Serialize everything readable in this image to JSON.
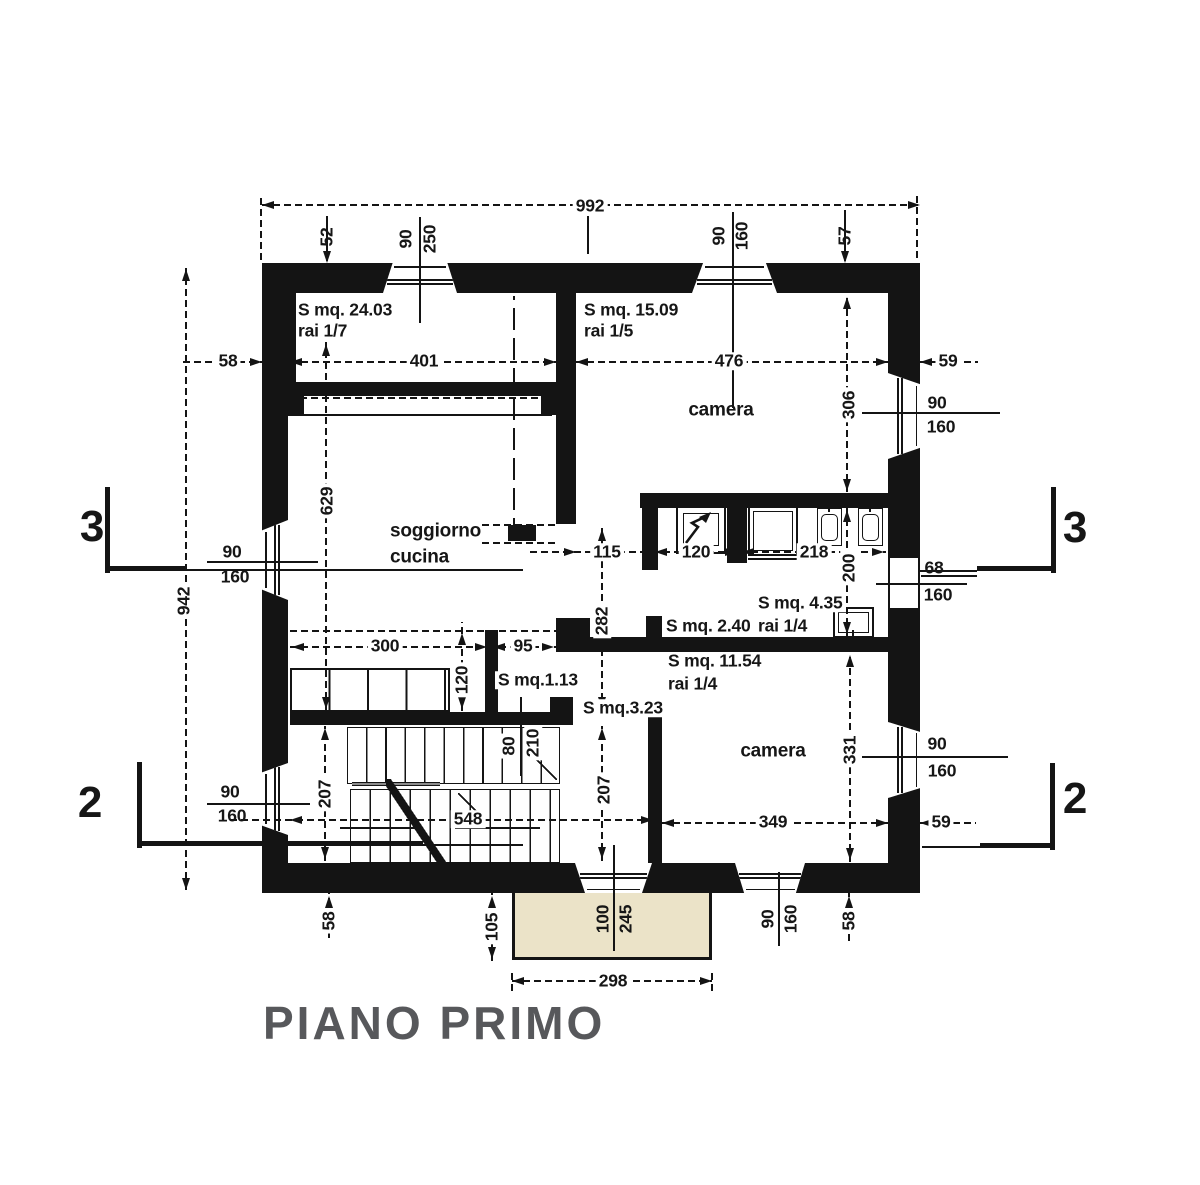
{
  "title": "PIANO PRIMO",
  "drawing": {
    "colors": {
      "ink": "#141414",
      "balcony_fill": "#ebe3c8",
      "rail_fill": "#8b8b8b",
      "title_color": "#57585b",
      "background": "#ffffff"
    },
    "walls": [
      [
        262,
        263,
        658,
        30
      ],
      [
        262,
        263,
        34,
        152
      ],
      [
        262,
        414,
        26,
        479
      ],
      [
        888,
        263,
        32,
        630
      ],
      [
        262,
        863,
        658,
        30
      ],
      [
        556,
        293,
        20,
        231
      ],
      [
        300,
        382,
        243,
        14
      ],
      [
        290,
        382,
        14,
        33
      ],
      [
        541,
        382,
        15,
        33
      ],
      [
        508,
        525,
        28,
        16
      ],
      [
        640,
        493,
        248,
        15
      ],
      [
        642,
        493,
        16,
        77
      ],
      [
        727,
        505,
        20,
        58
      ],
      [
        646,
        616,
        16,
        22
      ],
      [
        556,
        618,
        34,
        34
      ],
      [
        556,
        637,
        332,
        15
      ],
      [
        485,
        630,
        13,
        83
      ],
      [
        290,
        712,
        262,
        13
      ],
      [
        550,
        697,
        23,
        28
      ],
      [
        648,
        708,
        14,
        157
      ]
    ],
    "windows": [
      [
        383,
        263,
        74,
        30,
        "t"
      ],
      [
        692,
        263,
        85,
        30,
        "t"
      ],
      [
        262,
        520,
        26,
        80,
        "l"
      ],
      [
        262,
        763,
        26,
        72,
        "l"
      ],
      [
        888,
        373,
        32,
        86,
        "r"
      ],
      [
        890,
        558,
        28,
        50,
        "p"
      ],
      [
        888,
        722,
        32,
        76,
        "r"
      ],
      [
        575,
        863,
        77,
        30,
        "b"
      ],
      [
        735,
        863,
        70,
        30,
        "b"
      ]
    ],
    "boxes": [
      [
        676,
        506,
        50,
        48,
        2,
        0
      ],
      [
        683,
        513,
        36,
        33,
        1.5,
        0
      ],
      [
        748,
        506,
        50,
        50,
        2,
        0
      ],
      [
        753,
        511,
        40,
        40,
        1,
        0
      ],
      [
        817,
        508,
        25,
        38,
        1.5,
        0
      ],
      [
        821,
        514,
        17,
        27,
        1.5,
        5
      ],
      [
        858,
        508,
        25,
        38,
        1.5,
        0
      ],
      [
        862,
        514,
        17,
        27,
        1.5,
        5
      ],
      [
        833,
        607,
        41,
        31,
        2,
        0
      ],
      [
        838,
        612,
        31,
        21,
        1.5,
        0
      ]
    ],
    "lines": [
      [
        262,
        205,
        920,
        205,
        "d"
      ],
      [
        261,
        195,
        261,
        260,
        "d"
      ],
      [
        917,
        196,
        917,
        258,
        "d"
      ],
      [
        588,
        216,
        588,
        254,
        "s"
      ],
      [
        327,
        216,
        327,
        261,
        "s"
      ],
      [
        420,
        217,
        420,
        323,
        "s"
      ],
      [
        733,
        212,
        733,
        408,
        "s"
      ],
      [
        845,
        210,
        845,
        261,
        "s"
      ],
      [
        183,
        362,
        262,
        362,
        "d"
      ],
      [
        290,
        362,
        556,
        362,
        "d"
      ],
      [
        576,
        362,
        888,
        362,
        "d"
      ],
      [
        920,
        362,
        978,
        362,
        "d"
      ],
      [
        186,
        268,
        186,
        890,
        "d"
      ],
      [
        326,
        342,
        326,
        710,
        "d"
      ],
      [
        847,
        295,
        847,
        492,
        "d"
      ],
      [
        862,
        413,
        1000,
        413,
        "s"
      ],
      [
        107,
        487,
        107,
        573,
        "s",
        5
      ],
      [
        107,
        568,
        185,
        568,
        "s",
        5
      ],
      [
        185,
        570,
        523,
        570,
        "s",
        1.5
      ],
      [
        1053,
        487,
        1053,
        573,
        "s",
        5
      ],
      [
        977,
        568,
        1053,
        568,
        "s",
        5
      ],
      [
        918,
        571,
        977,
        571,
        "s",
        1.5
      ],
      [
        207,
        562,
        318,
        562,
        "s",
        1.5
      ],
      [
        300,
        398,
        545,
        398,
        "d"
      ],
      [
        287,
        415,
        552,
        415,
        "s",
        1.5
      ],
      [
        514,
        296,
        514,
        540,
        "D"
      ],
      [
        530,
        552,
        662,
        552,
        "d"
      ],
      [
        652,
        552,
        740,
        552,
        "d"
      ],
      [
        740,
        552,
        886,
        552,
        "d"
      ],
      [
        847,
        508,
        847,
        636,
        "d"
      ],
      [
        602,
        527,
        602,
        711,
        "d"
      ],
      [
        482,
        525,
        556,
        525,
        "d"
      ],
      [
        482,
        543,
        556,
        543,
        "d"
      ],
      [
        290,
        647,
        556,
        647,
        "d"
      ],
      [
        290,
        631,
        556,
        631,
        "d"
      ],
      [
        462,
        622,
        462,
        711,
        "d"
      ],
      [
        748,
        559,
        797,
        559,
        "s",
        1.5
      ],
      [
        829,
        496,
        829,
        512,
        "s",
        1.5
      ],
      [
        870,
        496,
        870,
        512,
        "s",
        1.5
      ],
      [
        853,
        630,
        853,
        651,
        "s",
        1.5
      ],
      [
        921,
        576,
        977,
        576,
        "s",
        1.5
      ],
      [
        876,
        584,
        967,
        584,
        "s",
        1.5
      ],
      [
        521,
        697,
        521,
        776,
        "s",
        1.5
      ],
      [
        325,
        726,
        325,
        861,
        "d"
      ],
      [
        602,
        726,
        602,
        861,
        "d"
      ],
      [
        230,
        820,
        653,
        820,
        "d"
      ],
      [
        207,
        804,
        310,
        804,
        "s",
        1.5
      ],
      [
        139,
        762,
        139,
        848,
        "s",
        5
      ],
      [
        139,
        843,
        423,
        843,
        "s",
        5
      ],
      [
        423,
        845,
        523,
        845,
        "s",
        1.5
      ],
      [
        1052,
        763,
        1052,
        850,
        "s",
        5
      ],
      [
        980,
        845,
        1052,
        845,
        "s",
        5
      ],
      [
        922,
        847,
        980,
        847,
        "s",
        1.5
      ],
      [
        662,
        823,
        888,
        823,
        "d"
      ],
      [
        920,
        823,
        976,
        823,
        "d"
      ],
      [
        850,
        653,
        850,
        862,
        "d"
      ],
      [
        862,
        757,
        1008,
        757,
        "s",
        1.5
      ],
      [
        614,
        845,
        614,
        951,
        "s",
        1.5
      ],
      [
        779,
        872,
        779,
        946,
        "s",
        1.5
      ],
      [
        329,
        893,
        329,
        938,
        "d"
      ],
      [
        849,
        893,
        849,
        941,
        "d"
      ],
      [
        492,
        893,
        492,
        961,
        "d"
      ],
      [
        512,
        981,
        712,
        981,
        "d"
      ],
      [
        512,
        971,
        512,
        991,
        "d"
      ],
      [
        712,
        971,
        712,
        991,
        "d"
      ],
      [
        340,
        828,
        420,
        828,
        "s",
        1.5
      ],
      [
        455,
        828,
        540,
        828,
        "s",
        1.5
      ]
    ],
    "arrows": [
      [
        262,
        205,
        "l"
      ],
      [
        920,
        205,
        "r"
      ],
      [
        327,
        263,
        "d"
      ],
      [
        845,
        263,
        "d"
      ],
      [
        262,
        362,
        "r"
      ],
      [
        290,
        362,
        "l"
      ],
      [
        556,
        362,
        "r"
      ],
      [
        576,
        362,
        "l"
      ],
      [
        888,
        362,
        "r"
      ],
      [
        920,
        362,
        "l"
      ],
      [
        186,
        269,
        "u"
      ],
      [
        186,
        890,
        "d"
      ],
      [
        326,
        344,
        "u"
      ],
      [
        326,
        709,
        "d"
      ],
      [
        847,
        297,
        "u"
      ],
      [
        847,
        491,
        "d"
      ],
      [
        576,
        552,
        "r"
      ],
      [
        643,
        552,
        "l"
      ],
      [
        655,
        552,
        "l"
      ],
      [
        737,
        552,
        "r"
      ],
      [
        742,
        552,
        "l"
      ],
      [
        884,
        552,
        "r"
      ],
      [
        847,
        510,
        "u"
      ],
      [
        847,
        634,
        "d"
      ],
      [
        602,
        529,
        "u"
      ],
      [
        602,
        709,
        "d"
      ],
      [
        292,
        647,
        "l"
      ],
      [
        487,
        647,
        "r"
      ],
      [
        493,
        647,
        "l"
      ],
      [
        554,
        647,
        "r"
      ],
      [
        462,
        633,
        "u"
      ],
      [
        462,
        709,
        "d"
      ],
      [
        325,
        728,
        "u"
      ],
      [
        325,
        859,
        "d"
      ],
      [
        602,
        728,
        "u"
      ],
      [
        602,
        859,
        "d"
      ],
      [
        290,
        820,
        "l"
      ],
      [
        653,
        820,
        "r"
      ],
      [
        662,
        823,
        "l"
      ],
      [
        888,
        823,
        "r"
      ],
      [
        920,
        823,
        "l"
      ],
      [
        850,
        655,
        "u"
      ],
      [
        850,
        860,
        "d"
      ],
      [
        329,
        896,
        "u"
      ],
      [
        849,
        896,
        "u"
      ],
      [
        492,
        896,
        "u"
      ],
      [
        492,
        959,
        "d"
      ],
      [
        512,
        981,
        "l"
      ],
      [
        712,
        981,
        "r"
      ]
    ],
    "labels": [
      {
        "t": "992",
        "x": 590,
        "y": 206,
        "bg": 1
      },
      {
        "t": "52",
        "x": 327,
        "y": 237,
        "r": 1
      },
      {
        "t": "90",
        "x": 406,
        "y": 239,
        "r": 1
      },
      {
        "t": "250",
        "x": 430,
        "y": 239,
        "r": 1
      },
      {
        "t": "90",
        "x": 719,
        "y": 236,
        "r": 1
      },
      {
        "t": "160",
        "x": 742,
        "y": 236,
        "r": 1
      },
      {
        "t": "57",
        "x": 845,
        "y": 236,
        "r": 1
      },
      {
        "t": "58",
        "x": 228,
        "y": 361,
        "bg": 1
      },
      {
        "t": "401",
        "x": 424,
        "y": 361,
        "bg": 1
      },
      {
        "t": "476",
        "x": 729,
        "y": 361,
        "bg": 1
      },
      {
        "t": "59",
        "x": 948,
        "y": 361,
        "bg": 1
      },
      {
        "t": "S mq. 24.03",
        "x": 298,
        "y": 310,
        "a": "l"
      },
      {
        "t": "rai 1/7",
        "x": 298,
        "y": 331,
        "a": "l"
      },
      {
        "t": "S mq. 15.09",
        "x": 584,
        "y": 310,
        "a": "l"
      },
      {
        "t": "rai 1/5",
        "x": 584,
        "y": 331,
        "a": "l"
      },
      {
        "t": "camera",
        "x": 721,
        "y": 410,
        "fs": 19
      },
      {
        "t": "90",
        "x": 937,
        "y": 403
      },
      {
        "t": "160",
        "x": 941,
        "y": 427
      },
      {
        "t": "306",
        "x": 849,
        "y": 405,
        "r": 1,
        "bg": 1
      },
      {
        "t": "3",
        "x": 92,
        "y": 527,
        "fs": 44
      },
      {
        "t": "3",
        "x": 1075,
        "y": 528,
        "fs": 44
      },
      {
        "t": "90",
        "x": 232,
        "y": 552
      },
      {
        "t": "160",
        "x": 235,
        "y": 577
      },
      {
        "t": "942",
        "x": 184,
        "y": 601,
        "r": 1,
        "bg": 1
      },
      {
        "t": "629",
        "x": 327,
        "y": 501,
        "r": 1,
        "bg": 1
      },
      {
        "t": "soggiorno",
        "x": 390,
        "y": 531,
        "a": "l",
        "fs": 19
      },
      {
        "t": "cucina",
        "x": 390,
        "y": 557,
        "a": "l",
        "fs": 19
      },
      {
        "t": "115",
        "x": 607,
        "y": 552,
        "bg": 1
      },
      {
        "t": "120",
        "x": 696,
        "y": 552,
        "bg": 1
      },
      {
        "t": "218",
        "x": 814,
        "y": 552,
        "bg": 1
      },
      {
        "t": "68",
        "x": 934,
        "y": 568
      },
      {
        "t": "160",
        "x": 938,
        "y": 595
      },
      {
        "t": "200",
        "x": 849,
        "y": 568,
        "r": 1,
        "bg": 1
      },
      {
        "t": "S mq. 2.40",
        "x": 663,
        "y": 626,
        "a": "l",
        "bg": 1
      },
      {
        "t": "S mq. 4.35",
        "x": 755,
        "y": 603,
        "a": "l",
        "bg": 1
      },
      {
        "t": "rai 1/4",
        "x": 755,
        "y": 626,
        "a": "l",
        "bg": 1
      },
      {
        "t": "S mq. 11.54",
        "x": 668,
        "y": 661,
        "a": "l"
      },
      {
        "t": "rai 1/4",
        "x": 668,
        "y": 684,
        "a": "l"
      },
      {
        "t": "282",
        "x": 602,
        "y": 621,
        "r": 1,
        "bg": 1
      },
      {
        "t": "300",
        "x": 385,
        "y": 646,
        "bg": 1
      },
      {
        "t": "95",
        "x": 523,
        "y": 646,
        "bg": 1
      },
      {
        "t": "120",
        "x": 462,
        "y": 680,
        "r": 1,
        "bg": 1
      },
      {
        "t": "S mq.1.13",
        "x": 495,
        "y": 680,
        "a": "l",
        "bg": 1
      },
      {
        "t": "S mq.3.23",
        "x": 580,
        "y": 708,
        "a": "l",
        "bg": 1
      },
      {
        "t": "80",
        "x": 509,
        "y": 746,
        "r": 1,
        "bg": 1
      },
      {
        "t": "210",
        "x": 533,
        "y": 743,
        "r": 1,
        "bg": 1
      },
      {
        "t": "207",
        "x": 325,
        "y": 794,
        "r": 1,
        "bg": 1
      },
      {
        "t": "207",
        "x": 604,
        "y": 790,
        "r": 1,
        "bg": 1
      },
      {
        "t": "camera",
        "x": 773,
        "y": 751,
        "fs": 19
      },
      {
        "t": "331",
        "x": 850,
        "y": 750,
        "r": 1,
        "bg": 1
      },
      {
        "t": "90",
        "x": 230,
        "y": 792
      },
      {
        "t": "160",
        "x": 232,
        "y": 816
      },
      {
        "t": "2",
        "x": 90,
        "y": 803,
        "fs": 44
      },
      {
        "t": "2",
        "x": 1075,
        "y": 799,
        "fs": 44
      },
      {
        "t": "548",
        "x": 468,
        "y": 819,
        "bg": 1
      },
      {
        "t": "349",
        "x": 773,
        "y": 822,
        "bg": 1
      },
      {
        "t": "59",
        "x": 941,
        "y": 822,
        "bg": 1
      },
      {
        "t": "90",
        "x": 937,
        "y": 744
      },
      {
        "t": "160",
        "x": 942,
        "y": 771
      },
      {
        "t": "58",
        "x": 329,
        "y": 921,
        "r": 1,
        "bg": 1
      },
      {
        "t": "105",
        "x": 492,
        "y": 927,
        "r": 1,
        "bg": 1
      },
      {
        "t": "100",
        "x": 603,
        "y": 919,
        "r": 1
      },
      {
        "t": "245",
        "x": 626,
        "y": 919,
        "r": 1
      },
      {
        "t": "90",
        "x": 768,
        "y": 919,
        "r": 1
      },
      {
        "t": "160",
        "x": 791,
        "y": 919,
        "r": 1
      },
      {
        "t": "58",
        "x": 849,
        "y": 921,
        "r": 1,
        "bg": 1
      },
      {
        "t": "298",
        "x": 613,
        "y": 981,
        "bg": 1
      }
    ]
  }
}
